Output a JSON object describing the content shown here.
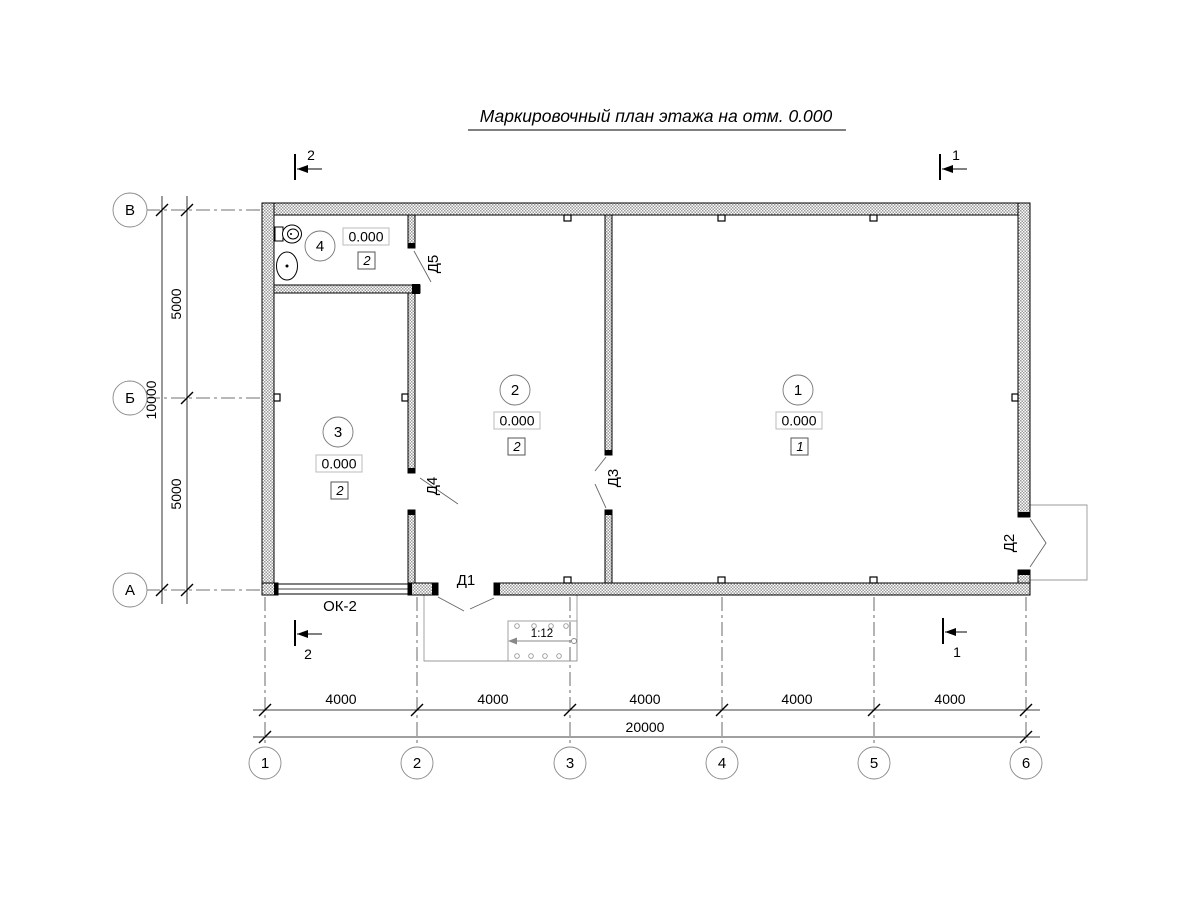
{
  "title": "Маркировочный план этажа на отм. 0.000",
  "rooms": [
    {
      "number": "1",
      "elevation": "0.000",
      "finish": "1"
    },
    {
      "number": "2",
      "elevation": "0.000",
      "finish": "2"
    },
    {
      "number": "3",
      "elevation": "0.000",
      "finish": "2"
    },
    {
      "number": "4",
      "elevation": "0.000",
      "finish": "2"
    }
  ],
  "doors": {
    "d1": "Д1",
    "d2": "Д2",
    "d3": "Д3",
    "d4": "Д4",
    "d5": "Д5"
  },
  "window": {
    "label": "ОК-2"
  },
  "ramp": {
    "slope": "1:12"
  },
  "axes": {
    "horizontal": [
      "1",
      "2",
      "3",
      "4",
      "5",
      "6"
    ],
    "vertical": [
      "В",
      "Б",
      "А"
    ]
  },
  "dims": {
    "bay": "4000",
    "total_width": "20000",
    "half": "5000",
    "total_depth": "10000"
  },
  "sections": {
    "one": "1",
    "two": "2"
  },
  "colors": {
    "line": "#000000",
    "hatch": "#9a9a9a",
    "light": "#999999"
  }
}
